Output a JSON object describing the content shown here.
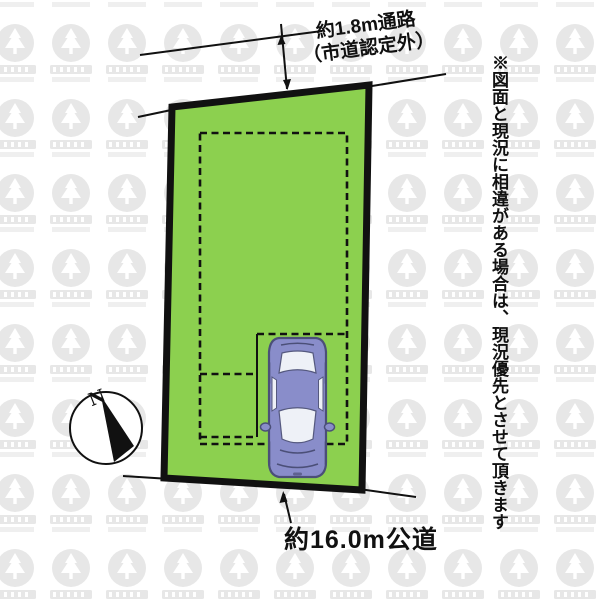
{
  "diagram": {
    "top_dimension": {
      "line1": "約1.8m通路",
      "line2": "（市道認定外）"
    },
    "bottom_dimension": {
      "label": "約16.0m公道"
    },
    "disclaimer": "※図面と現況に相違がある場合は、現況優先とさせて頂きます",
    "compass": {
      "north_label": "N"
    },
    "colors": {
      "plot_green": "#8cd04f",
      "line_black": "#111111",
      "car_body": "#898dca",
      "car_outline": "#4b4f78",
      "car_window": "#eef1f7",
      "watermark_gray": "#e7e7e7"
    }
  }
}
